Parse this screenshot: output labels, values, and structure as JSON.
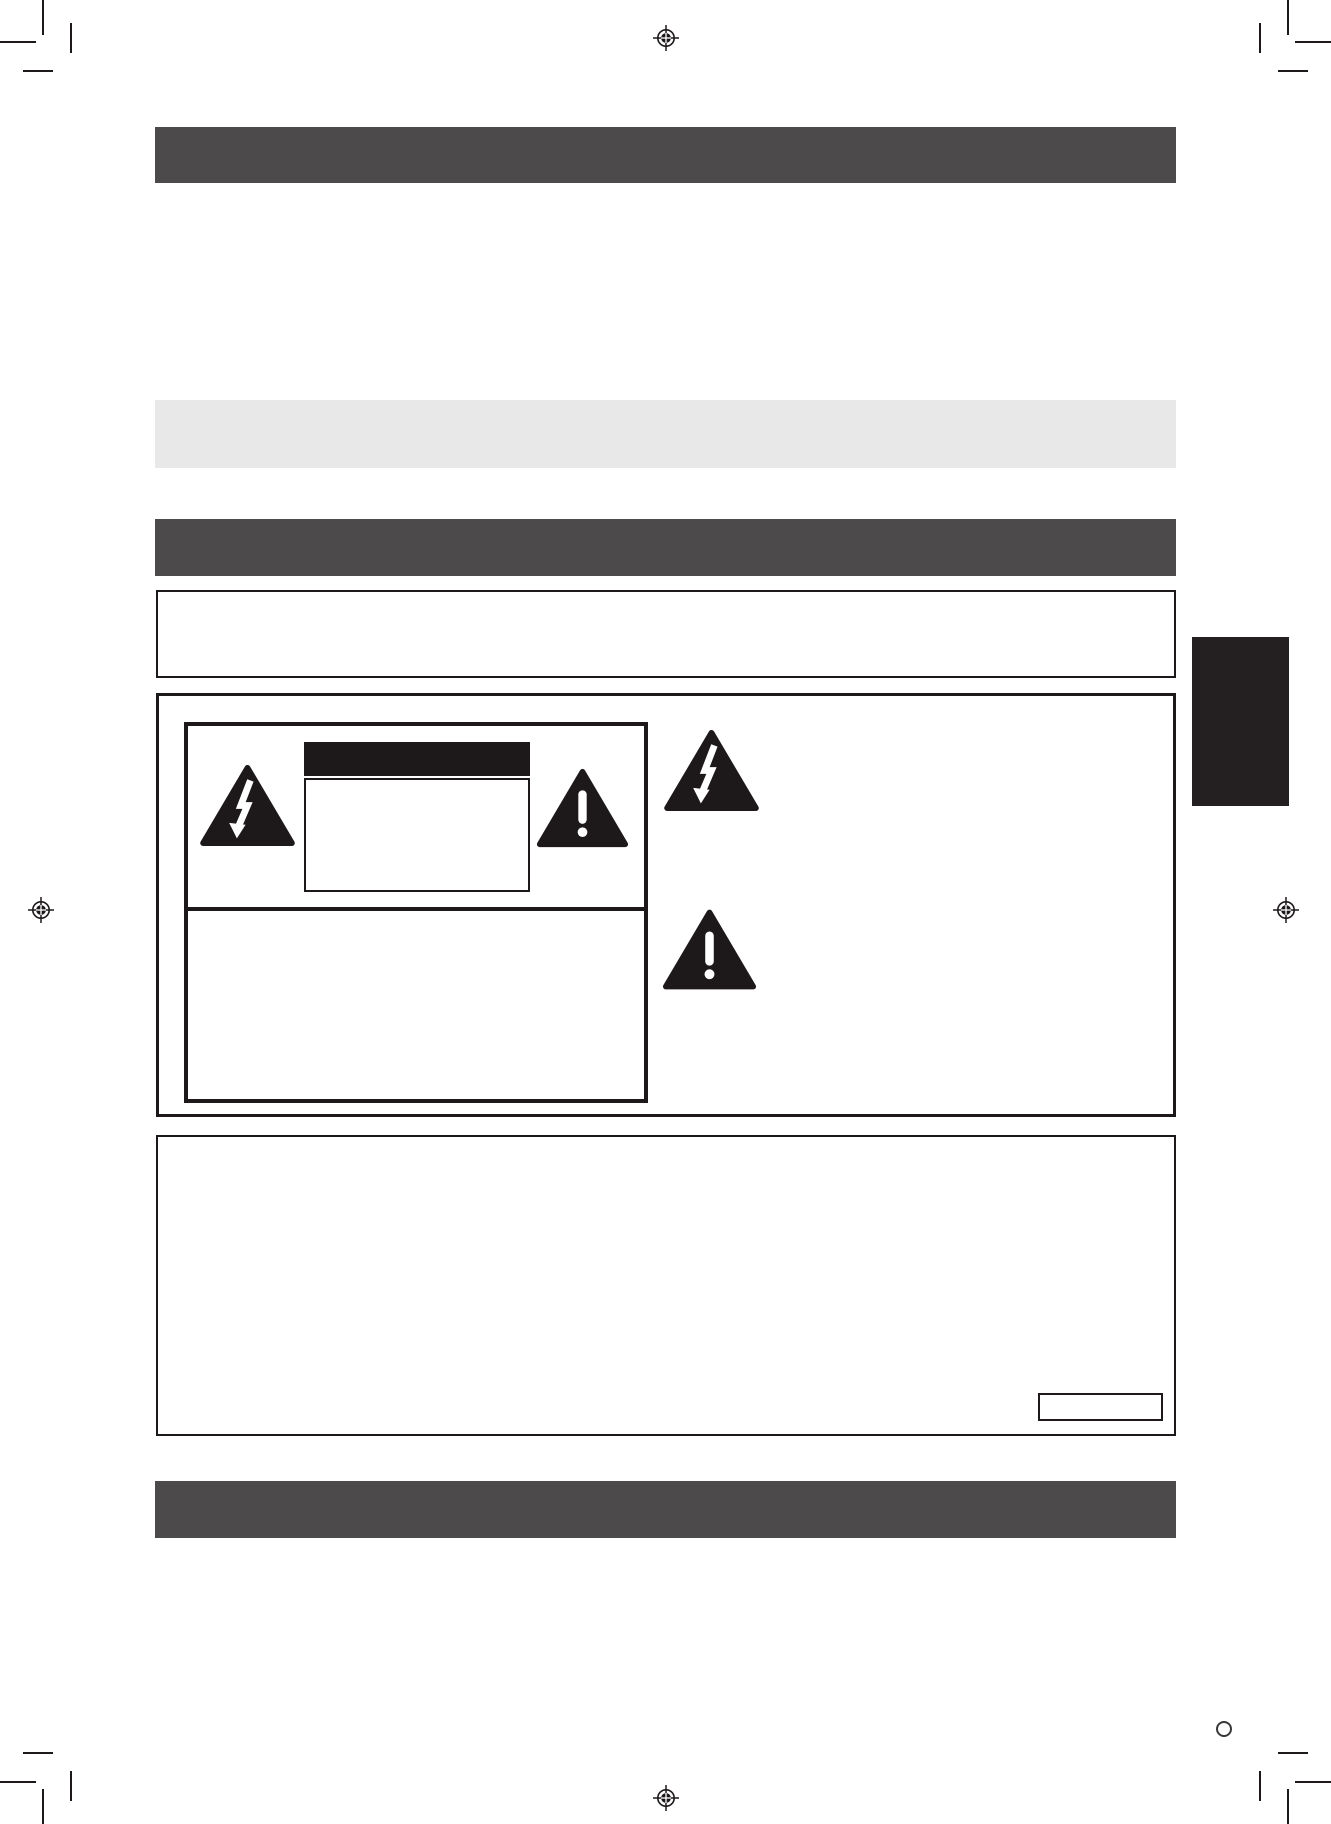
{
  "colors": {
    "page_bg": "#ffffff",
    "bar_dark": "#4d4a4b",
    "bar_light": "#e9e8e8",
    "ink_black": "#1d191a",
    "tab_black": "#242021"
  },
  "icons": {
    "electric_shock_icon": "lightning-bolt-arrow-inside-triangle",
    "alert_icon": "exclamation-mark-inside-triangle",
    "registration_mark_icon": "crosshair-circle-print-registration-mark",
    "crop_mark_icon": "double-corner-crop-marks",
    "page_circle_icon": "small-open-circle"
  },
  "blocks": {
    "section_bar_top": "solid dark-gray section header bar (no text rendered)",
    "subsection_bar": "light-gray highlight bar (no text rendered)",
    "section_bar_middle": "solid dark-gray section header bar (no text rendered)",
    "notice_box": "thin-bordered empty notice box",
    "warning_panel": "large bordered panel containing caution label artwork",
    "caution_label_box": "thick-bordered caution label with black title bar, inner text box and two warning triangles",
    "page_edge_tab": "solid black section thumb-tab at right page edge",
    "info_box": "large thin-bordered empty box with small inset box at lower right",
    "section_bar_bottom": "solid dark-gray section header bar (no text rendered)"
  }
}
